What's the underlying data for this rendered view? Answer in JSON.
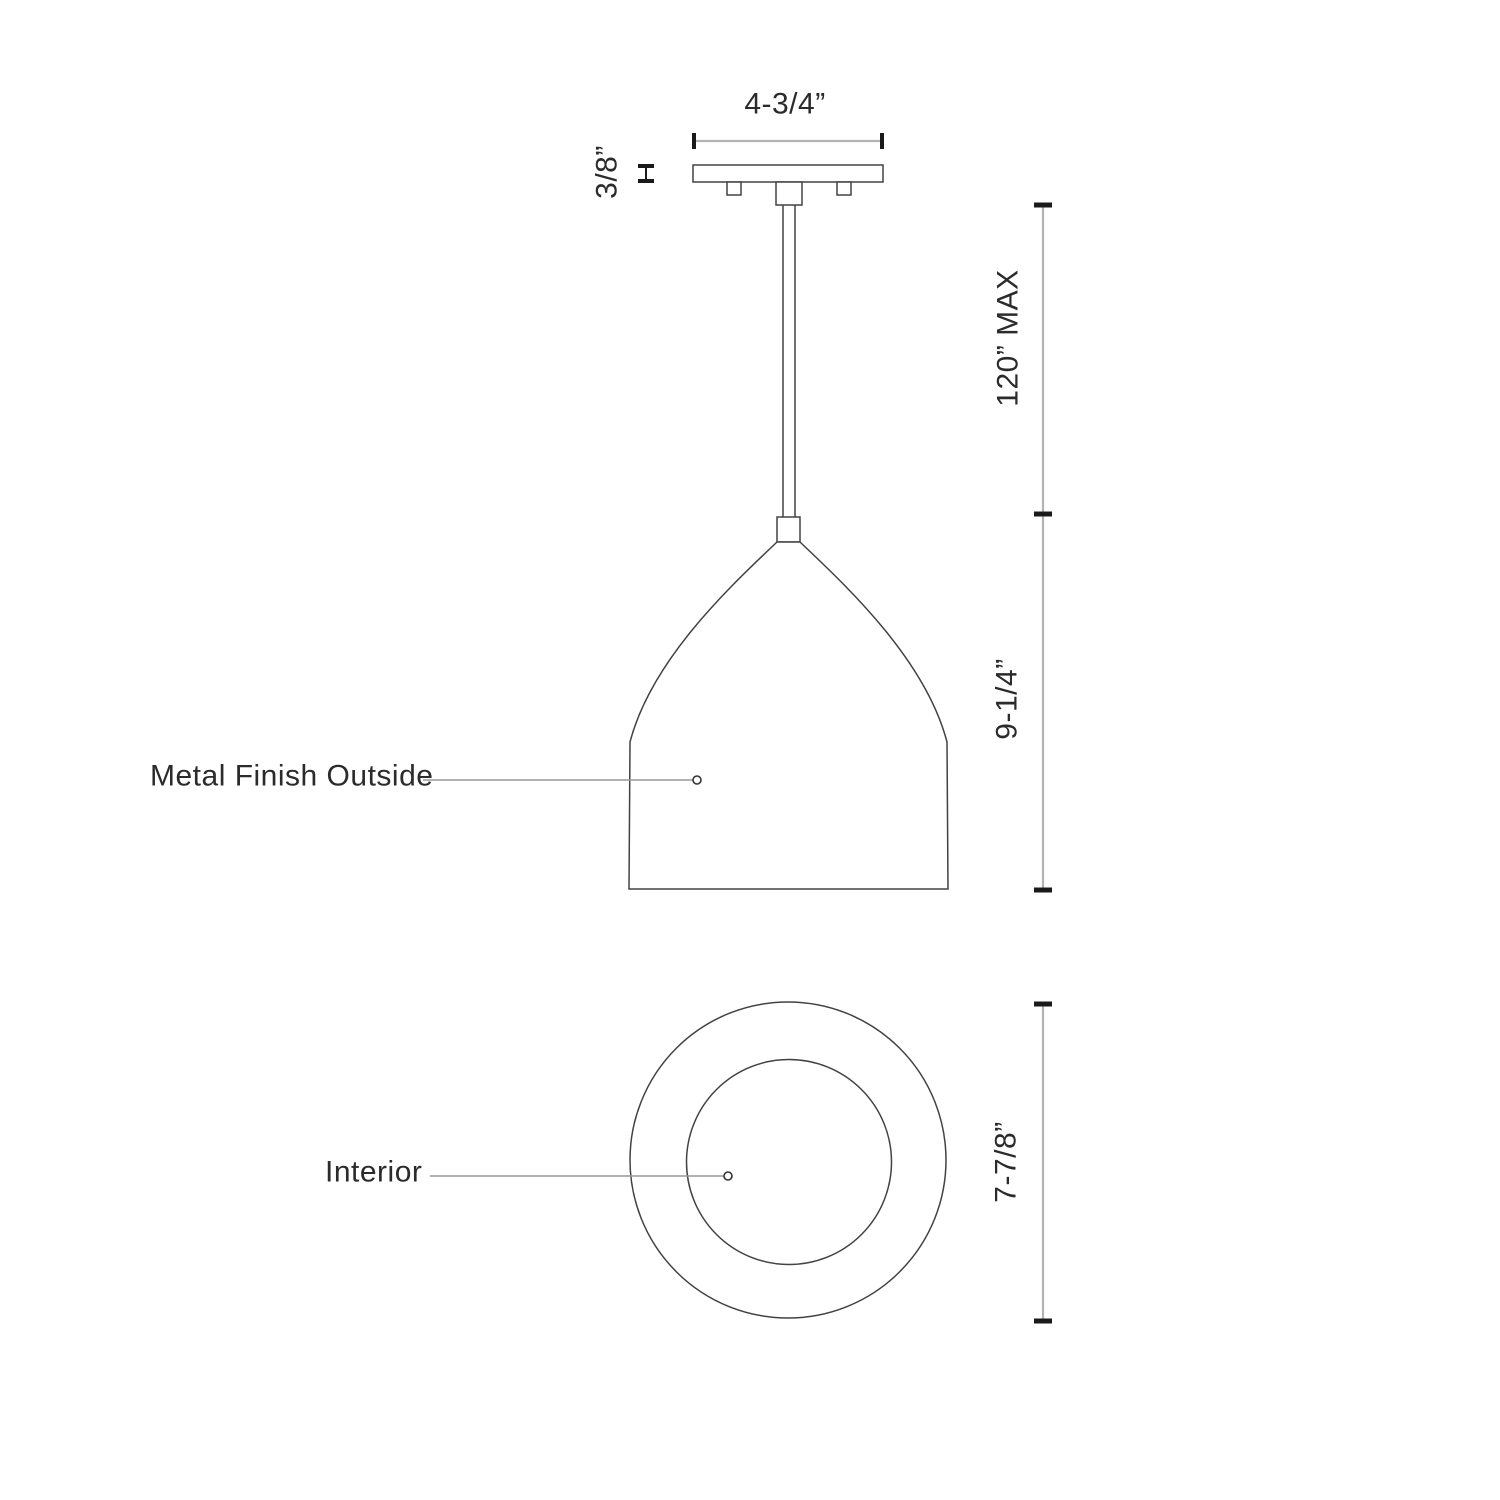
{
  "diagram": {
    "kind": "technical-dimension-drawing",
    "subject": "pendant light fixture",
    "front_view": {
      "canopy_width_label": "4-3/4”",
      "canopy_thickness_label": "3/8”",
      "suspension_max_label": "120” MAX",
      "shade_height_label": "9-1/4”",
      "finish_callout_label": "Metal Finish Outside"
    },
    "bottom_view": {
      "interior_callout_label": "Interior",
      "shade_diameter_label": "7-7/8”"
    },
    "colors": {
      "background": "#ffffff",
      "outline": "#424242",
      "dimension_line": "#b3b3b3",
      "tick": "#1a1a1a",
      "leader_line": "#999999",
      "text": "#2b2b2b"
    }
  }
}
